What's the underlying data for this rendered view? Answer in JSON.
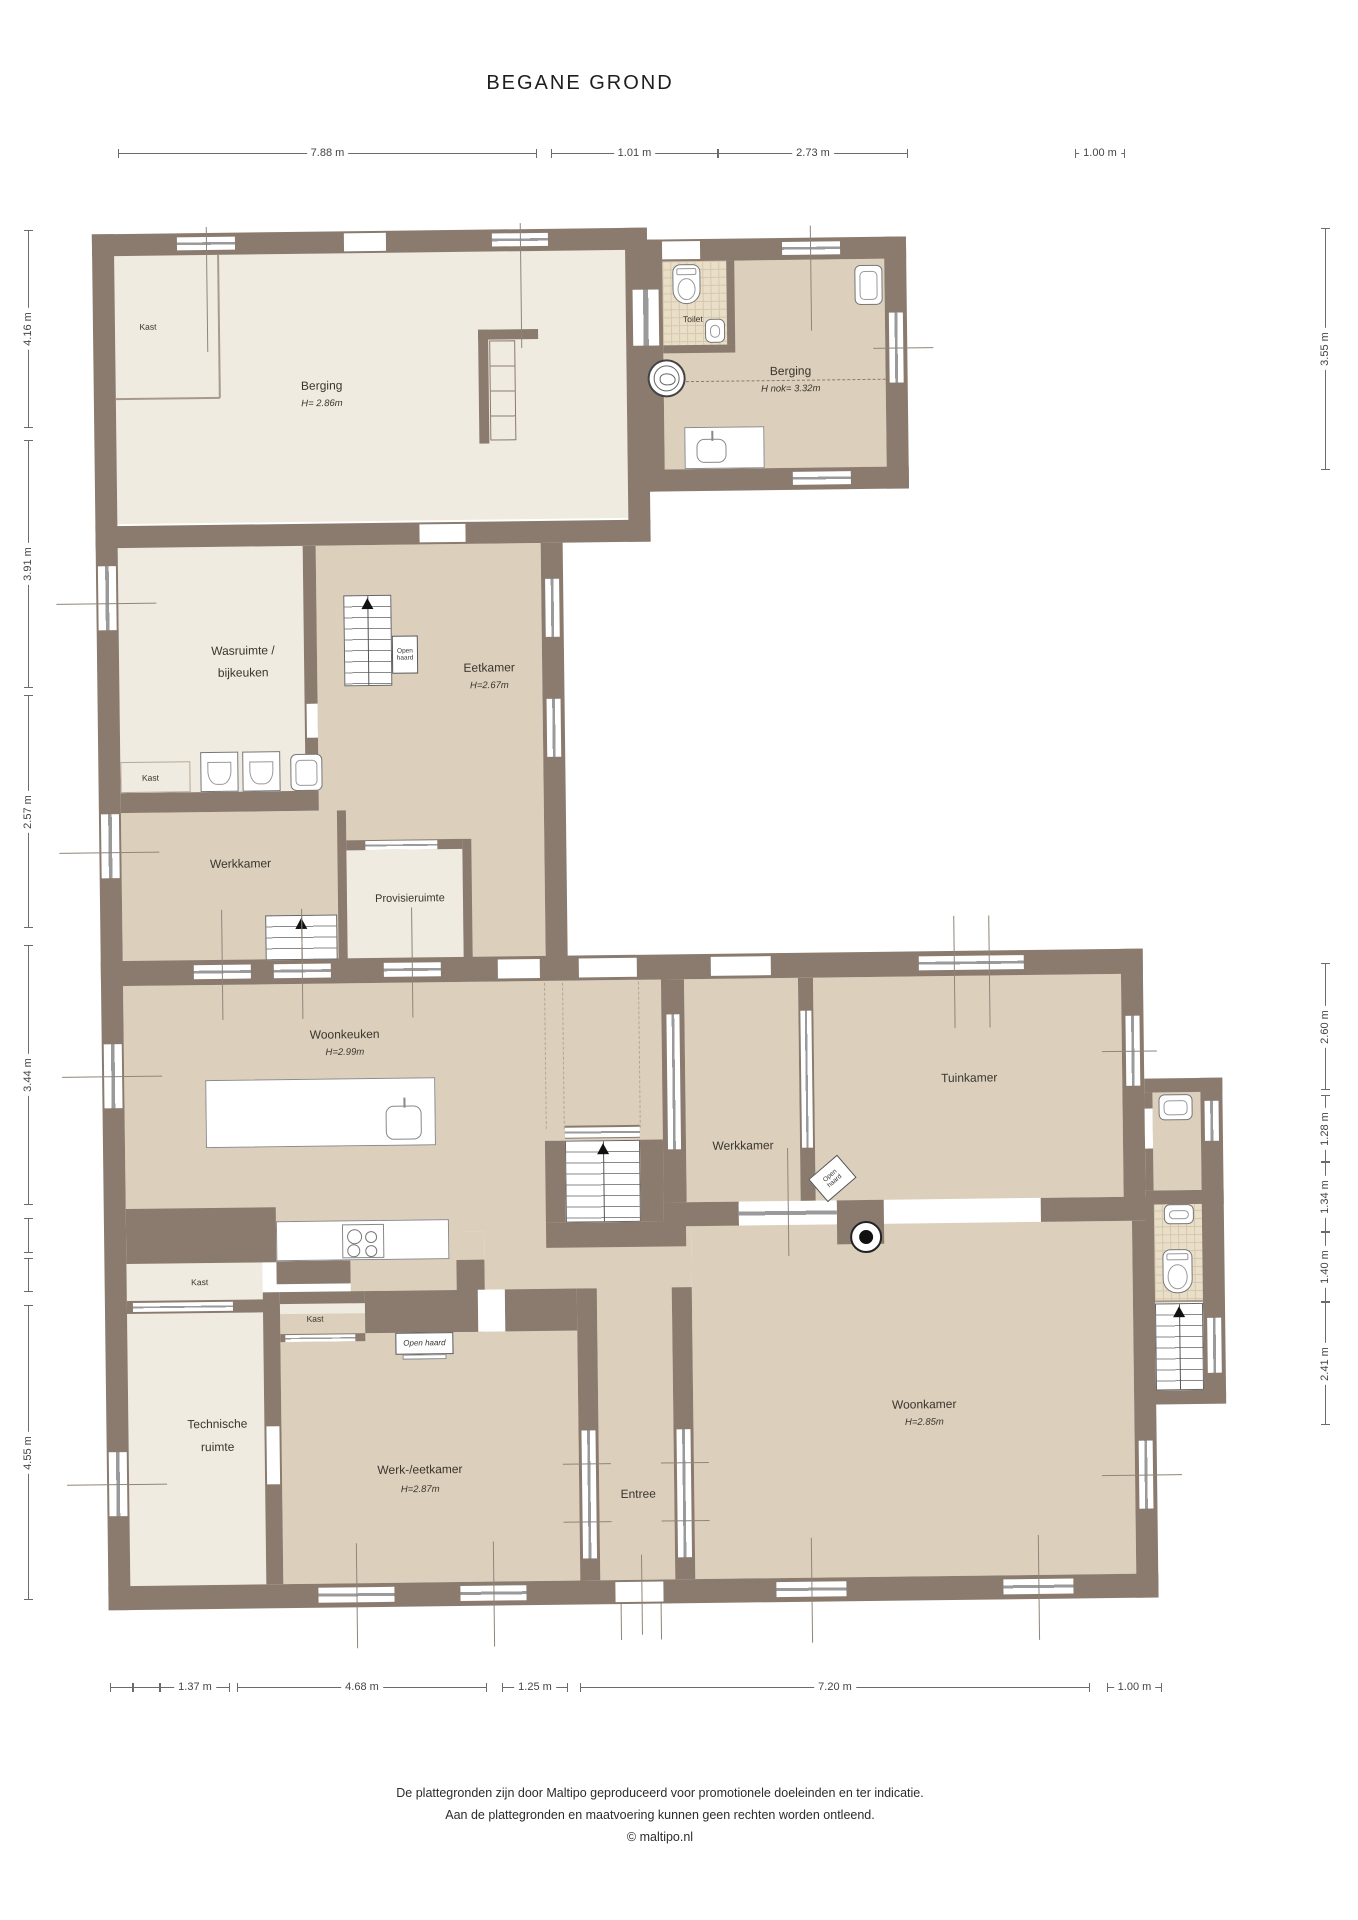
{
  "title": "BEGANE GROND",
  "dimensions": {
    "top": [
      "7.88 m",
      "1.01 m",
      "2.73 m",
      "1.00 m"
    ],
    "left": [
      "4.16 m",
      "3.91 m",
      "2.57 m",
      "3.44 m",
      "4.55 m"
    ],
    "right": [
      "3.55 m",
      "2.60 m",
      "1.28 m",
      "1.34 m",
      "1.40 m",
      "2.41 m"
    ],
    "bottom": [
      "1.37 m",
      "4.68 m",
      "1.25 m",
      "7.20 m",
      "1.00 m"
    ]
  },
  "rooms": {
    "berging_left": {
      "name": "Berging",
      "height": "H= 2.86m"
    },
    "toilet": {
      "name": "Toilet"
    },
    "berging_right": {
      "name": "Berging",
      "height": "H nok= 3.32m"
    },
    "wasruimte": {
      "line1": "Wasruimte /",
      "line2": "bijkeuken"
    },
    "eetkamer": {
      "name": "Eetkamer",
      "height": "H=2.67m"
    },
    "werkkamer_boven": {
      "name": "Werkkamer"
    },
    "provisieruimte": {
      "name": "Provisieruimte"
    },
    "woonkeuken": {
      "name": "Woonkeuken",
      "height": "H=2.99m"
    },
    "werkkamer_midden": {
      "name": "Werkkamer"
    },
    "tuinkamer": {
      "name": "Tuinkamer"
    },
    "technische_ruimte": {
      "line1": "Technische",
      "line2": "ruimte"
    },
    "werk_eetkamer": {
      "name": "Werk-/eetkamer",
      "height": "H=2.87m"
    },
    "entree": {
      "name": "Entree"
    },
    "woonkamer": {
      "name": "Woonkamer",
      "height": "H=2.85m"
    }
  },
  "labels": {
    "kast": "Kast",
    "open_haard": "Open haard"
  },
  "footer": {
    "line1": "De plattegronden zijn door Maltipo geproduceerd voor promotionele doeleinden en ter indicatie.",
    "line2": "Aan de plattegronden en maatvoering kunnen geen rechten worden ontleend.",
    "line3": "© maltipo.nl"
  },
  "colors": {
    "wall": "#8a7b6e",
    "floor_light": "#f0ebe0",
    "floor_dark": "#dcd0bc",
    "tile": "#e9dfc9",
    "background": "#ffffff"
  }
}
